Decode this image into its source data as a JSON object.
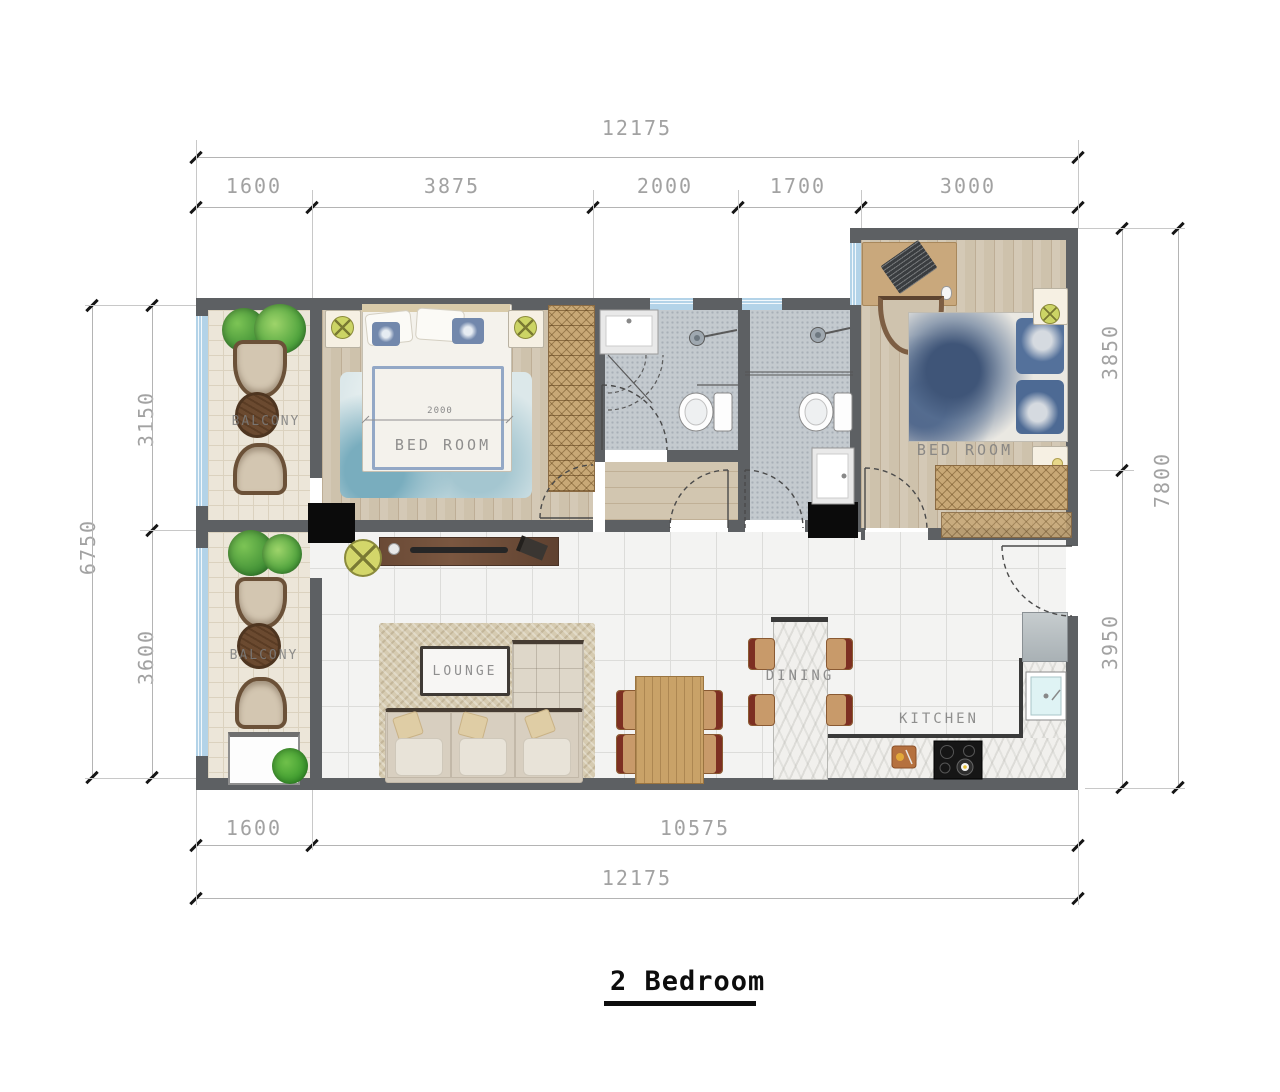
{
  "title": "2 Bedroom",
  "dimensions": {
    "top": {
      "overall": "12175",
      "segments": [
        "1600",
        "3875",
        "2000",
        "1700",
        "3000"
      ]
    },
    "bottom": {
      "overall": "12175",
      "segments": [
        "1600",
        "10575"
      ]
    },
    "left": {
      "overall": "6750",
      "segments": [
        "3150",
        "3600"
      ]
    },
    "right": {
      "overall": "7800",
      "segments": [
        "3850",
        "3950"
      ]
    }
  },
  "rooms": {
    "balcony_top": "BALCONY",
    "bedroom_1": "BED ROOM",
    "bedroom_2": "BED ROOM",
    "balcony_bottom": "BALCONY",
    "lounge": "LOUNGE",
    "dining": "DINING",
    "kitchen": "KITCHEN"
  },
  "annotations": {
    "bed_width": "2000"
  },
  "colors": {
    "wall": "#5d6063",
    "window": "#b3d3e8",
    "bath_tile": "#c4cacf",
    "wood_floor": "#cec2ac",
    "column": "#0b0b0b"
  }
}
